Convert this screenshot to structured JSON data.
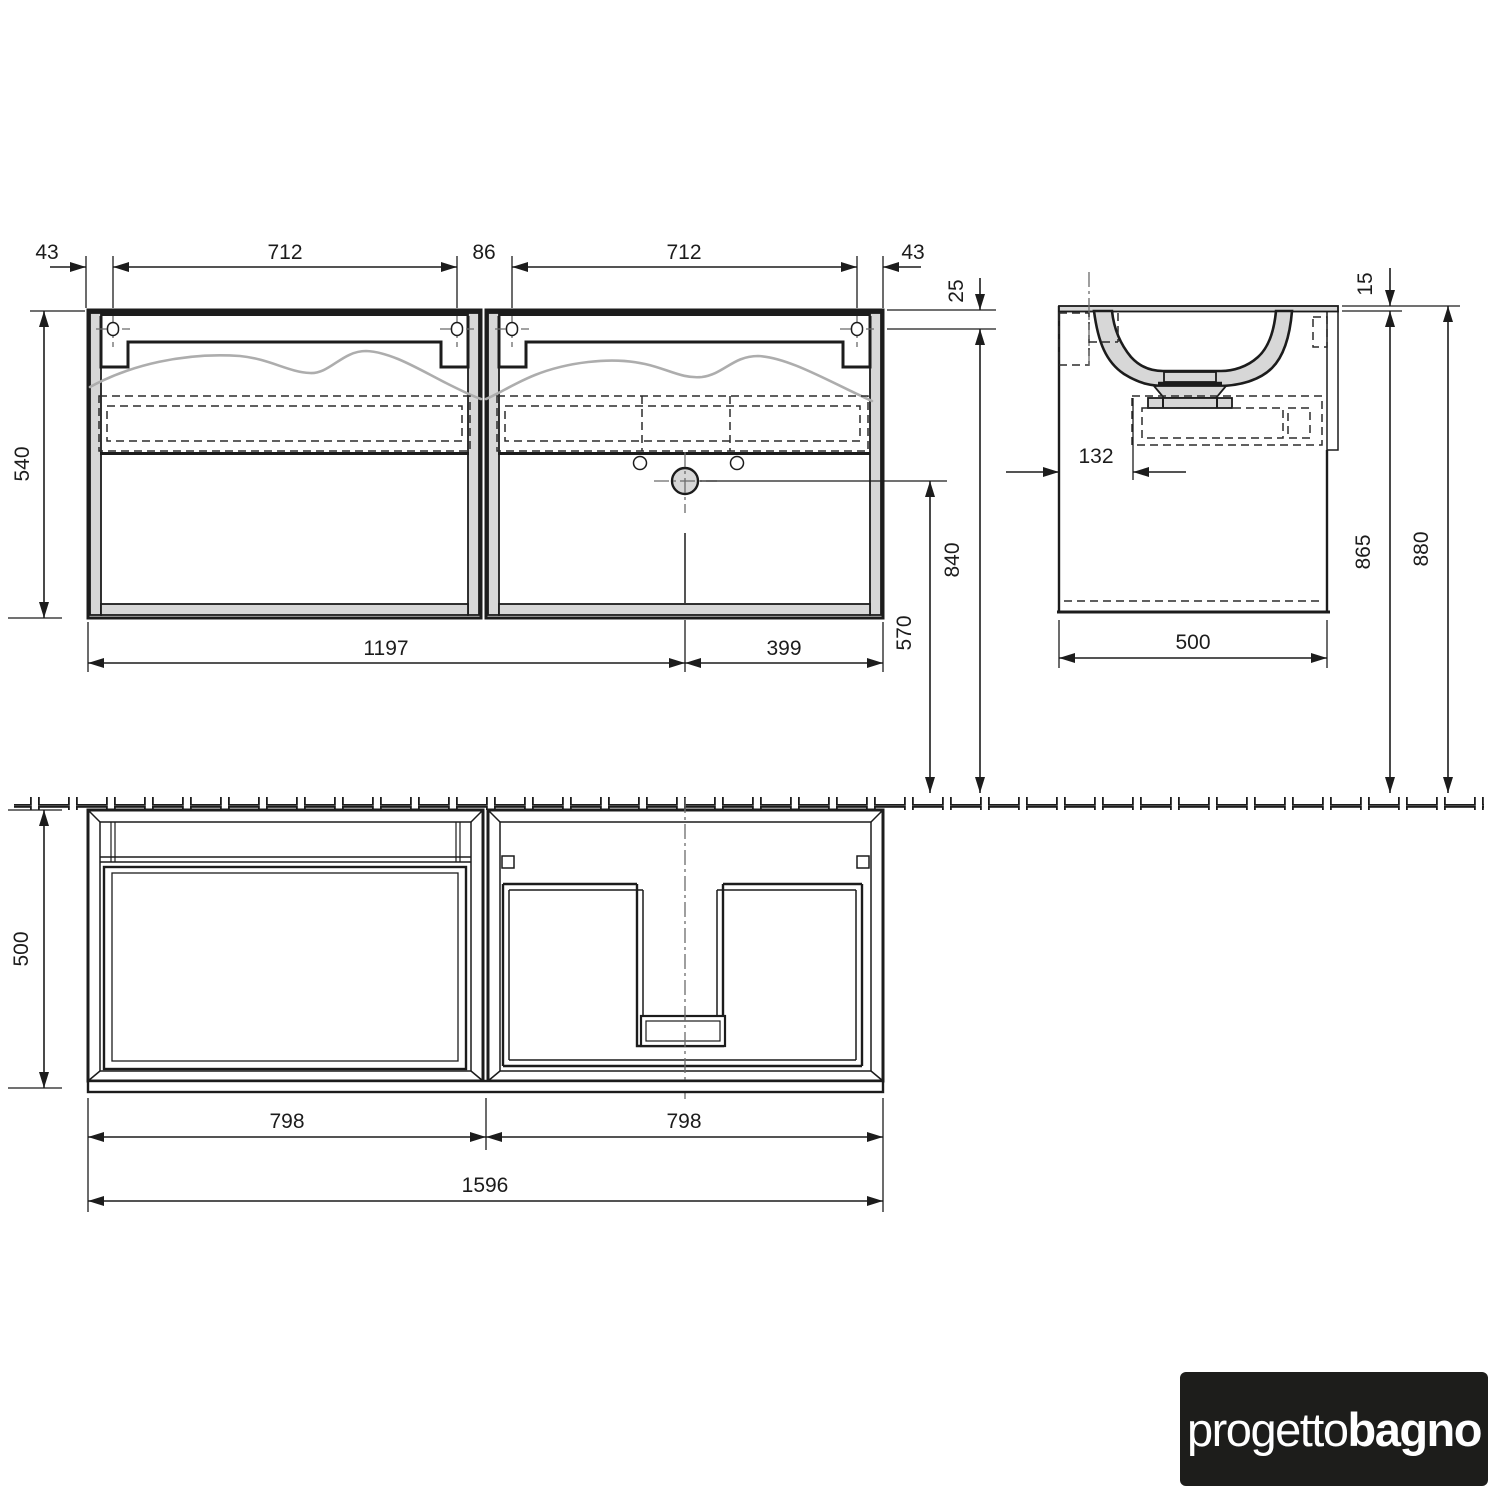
{
  "colors": {
    "background": "#ffffff",
    "line": "#1c1c1c",
    "panel_fill": "#d7d7d7",
    "basin_wave": "#adadad",
    "centerline": "#6b6b6b",
    "logo_background": "#1d1d1b",
    "logo_text": "#ffffff"
  },
  "brand": {
    "prefix": "progetto",
    "suffix": "bagno"
  },
  "dims": {
    "top_43_left": "43",
    "top_712_left": "712",
    "top_86": "86",
    "top_712_right": "712",
    "top_43_right": "43",
    "front_height": "540",
    "bottom_1197": "1197",
    "bottom_399": "399",
    "right_25": "25",
    "right_840": "840",
    "right_570": "570",
    "side_15": "15",
    "side_132": "132",
    "side_865": "865",
    "side_880": "880",
    "side_width": "500",
    "plan_depth": "500",
    "plan_798_left": "798",
    "plan_798_right": "798",
    "plan_total": "1596"
  }
}
